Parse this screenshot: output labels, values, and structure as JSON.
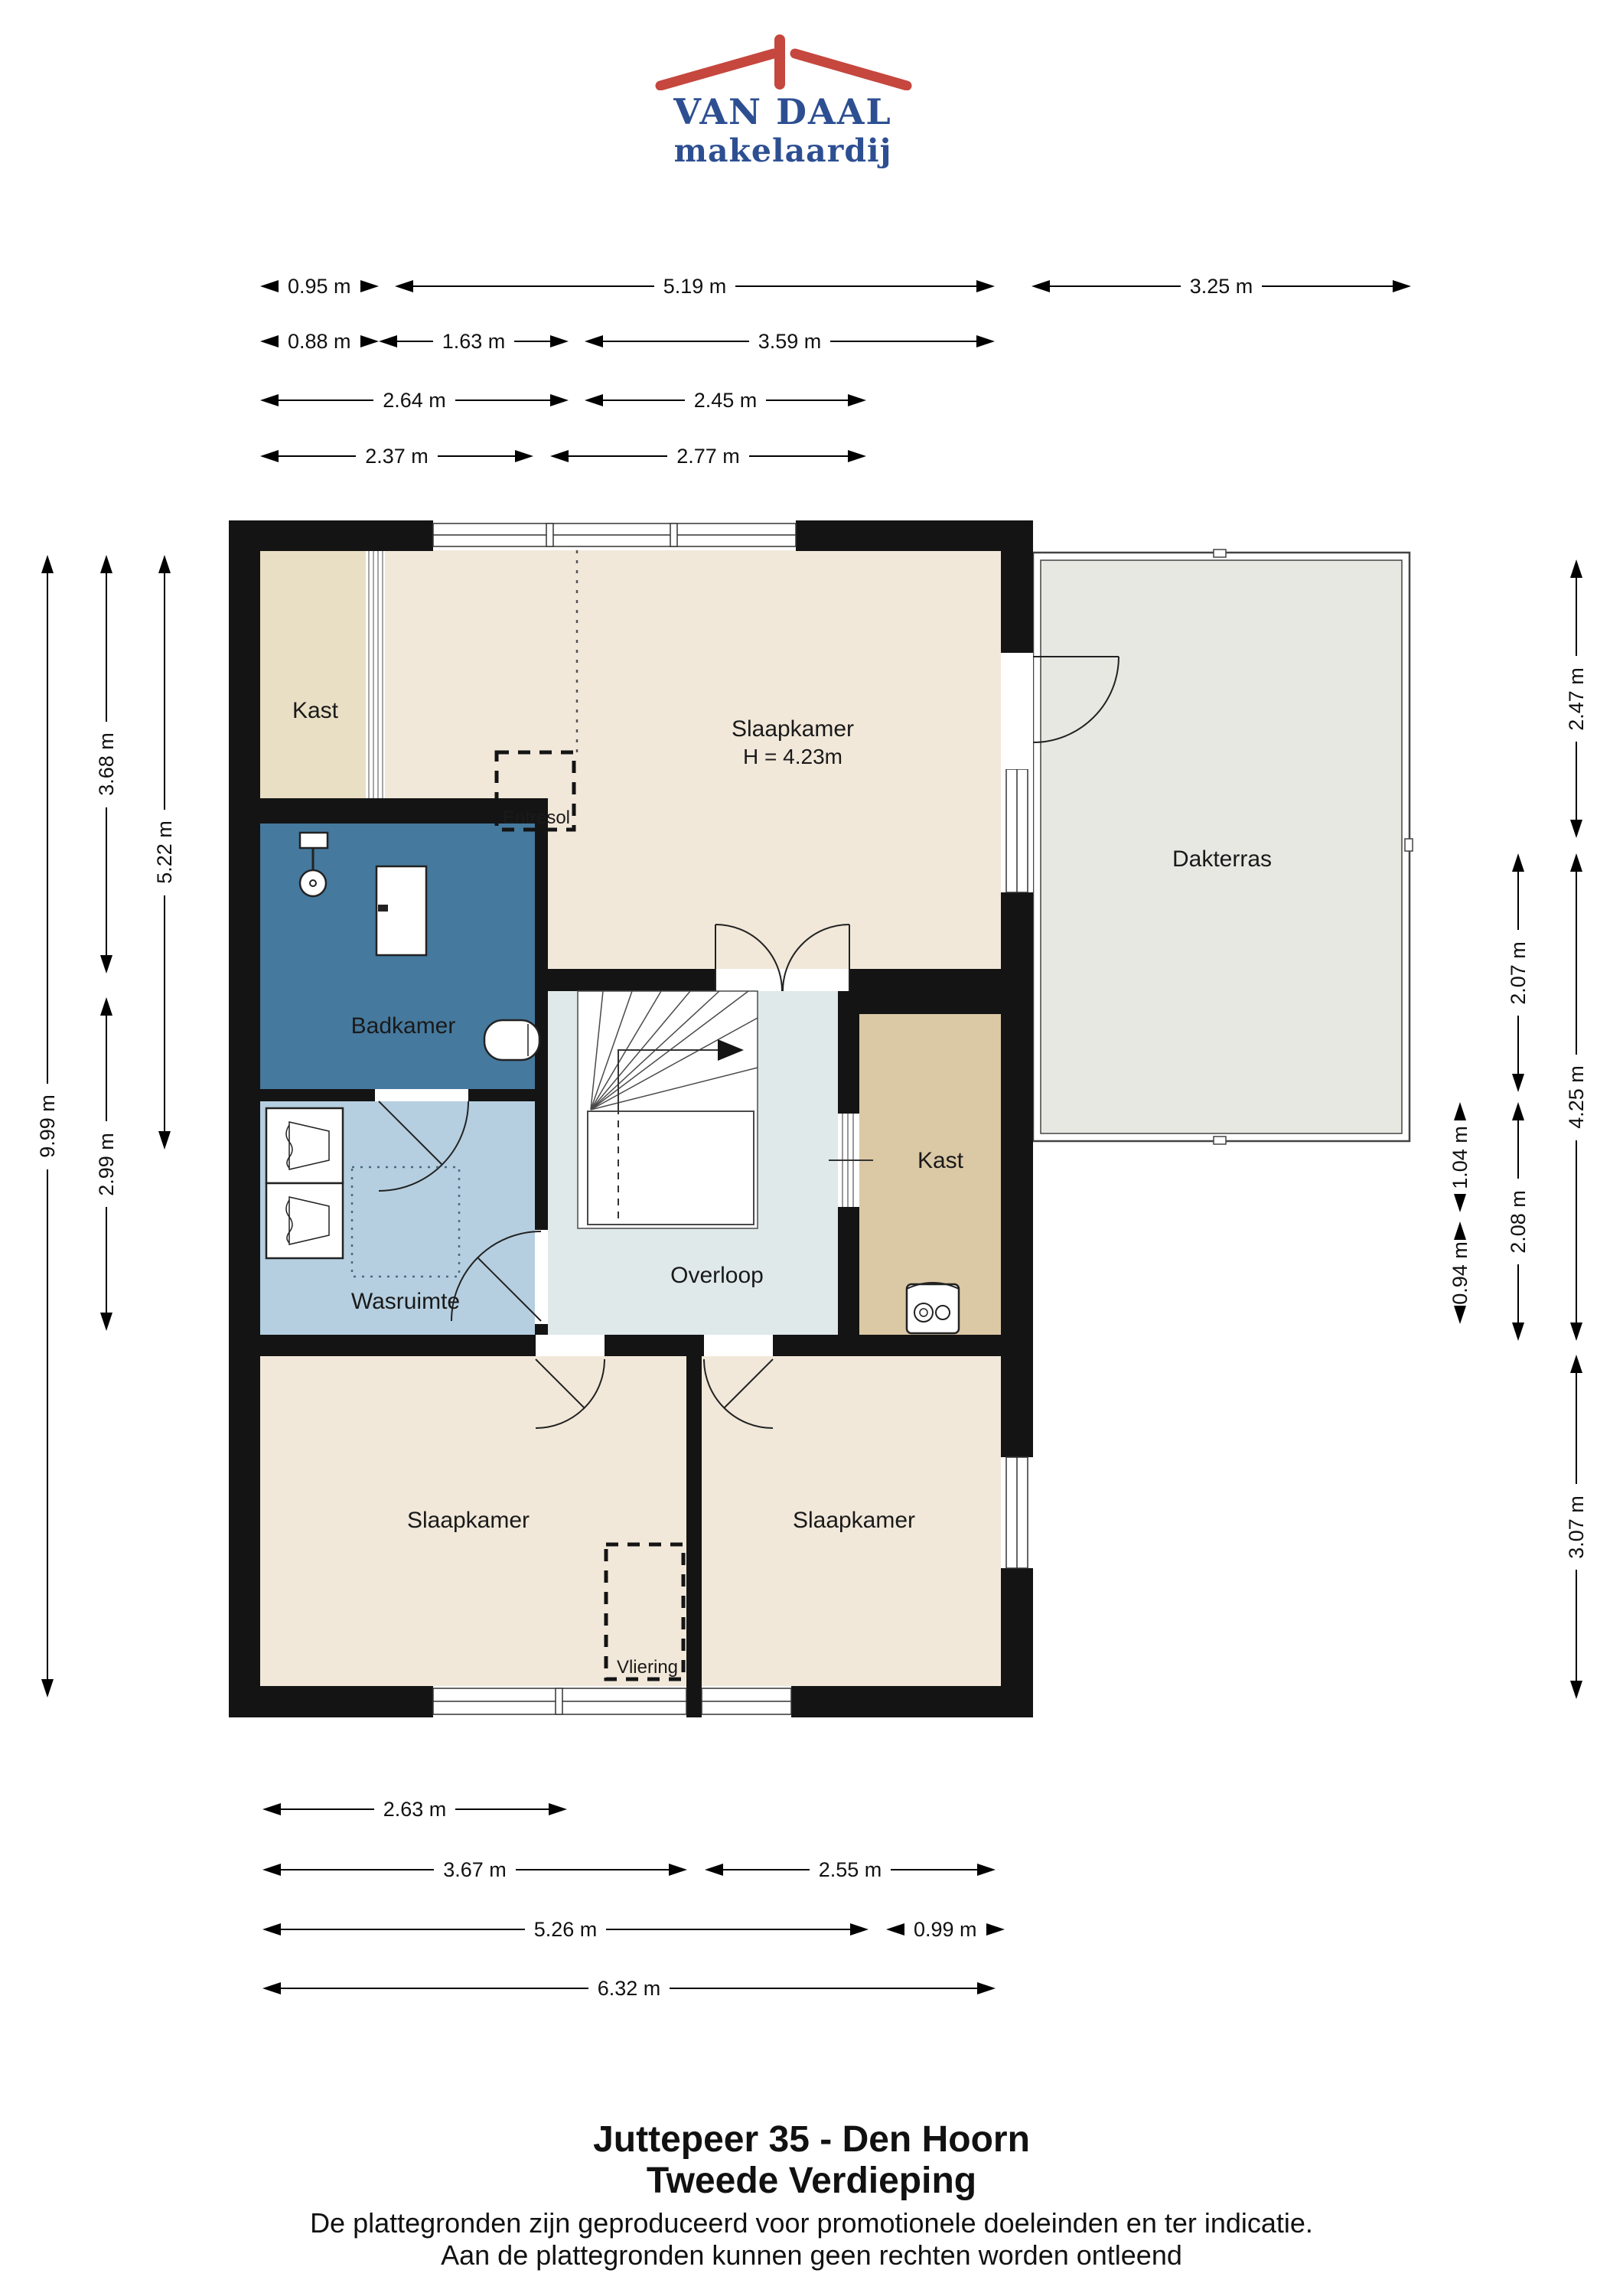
{
  "logo": {
    "name": "VAN DAAL",
    "subtitle": "makelaardij",
    "brand_blue": "#2d4f92",
    "brand_red": "#c5473e",
    "roof_icon": "house-roof-with-chimney"
  },
  "plan": {
    "rooms": {
      "kast_tl": "Kast",
      "slaapkamer_top": "Slaapkamer",
      "slaapkamer_top_height": "H = 4.23m",
      "entresol": "Entresol",
      "badkamer": "Badkamer",
      "wasruimte": "Wasruimte",
      "overloop": "Overloop",
      "kast_right": "Kast",
      "dakterras": "Dakterras",
      "slaapkamer_bl": "Slaapkamer",
      "slaapkamer_br": "Slaapkamer",
      "vliering": "Vliering"
    },
    "colors": {
      "wall": "#141414",
      "bedroom_cream": "#f1e8da",
      "closet_beige": "#e9dfc5",
      "closet_tan": "#dbc8a5",
      "bathroom_blue": "#45799e",
      "laundry_blue": "#b5cfe0",
      "landing_blue": "#dfe9ea",
      "terrace_grey": "#e8e8e3"
    }
  },
  "dims": {
    "top": [
      "0.95 m",
      "5.19 m",
      "3.25 m",
      "0.88 m",
      "1.63 m",
      "3.59 m",
      "2.64 m",
      "2.45 m",
      "2.37 m",
      "2.77 m"
    ],
    "bottom": [
      "2.63 m",
      "3.67 m",
      "2.55 m",
      "5.26 m",
      "0.99 m",
      "6.32 m"
    ],
    "left": [
      "9.99 m",
      "3.68 m",
      "2.99 m",
      "5.22 m"
    ],
    "right": [
      "2.47 m",
      "2.07 m",
      "2.08 m",
      "1.04 m",
      "0.94 m",
      "4.25 m",
      "3.07 m"
    ]
  },
  "footer": {
    "address": "Juttepeer 35 - Den Hoorn",
    "floor": "Tweede Verdieping",
    "disclaimer1": "De plattegronden zijn geproduceerd voor promotionele doeleinden en ter indicatie.",
    "disclaimer2": "Aan de plattegronden kunnen geen rechten worden ontleend"
  }
}
